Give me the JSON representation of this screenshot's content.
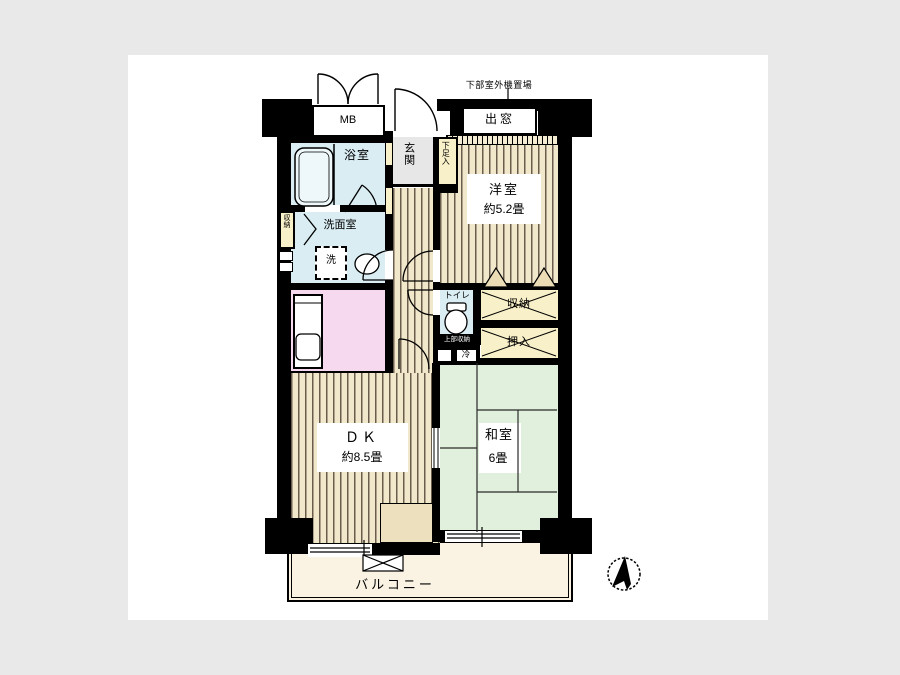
{
  "colors": {
    "page_bg": "#e9e9e9",
    "panel_bg": "#ffffff",
    "wall": "#000000",
    "wood_floor": "#f1e7ca",
    "wood_stripe": "#6b5d4e",
    "water_rooms": "#d9edf3",
    "kitchen": "#f6d9ee",
    "tatami": "#e1f0dc",
    "closet_cream": "#f8f0c9",
    "balcony": "#faf3e3",
    "entrance_tile": "#e7e7e7"
  },
  "plan": {
    "outdoor_unit_label": "下部室外機置場",
    "meter_box_label": "MB",
    "bay_window_label": "出窓",
    "bathroom_label": "浴室",
    "entrance_label": "玄関",
    "shoe_cabinet_label": "下足入",
    "hall_storage_label": "収納",
    "washroom_label": "洗面室",
    "washer_label": "洗",
    "toilet_label": "トイレ",
    "toilet_upper_storage_label": "上部収納",
    "refrigerator_label": "冷",
    "western_room": {
      "name": "洋室",
      "size": "約5.2畳"
    },
    "closet_label": "収納",
    "oshiire_label": "押入",
    "dining_kitchen": {
      "name": "ＤＫ",
      "size": "約8.5畳"
    },
    "japanese_room": {
      "name": "和室",
      "size": "6畳"
    },
    "balcony_label": "バルコニー"
  }
}
